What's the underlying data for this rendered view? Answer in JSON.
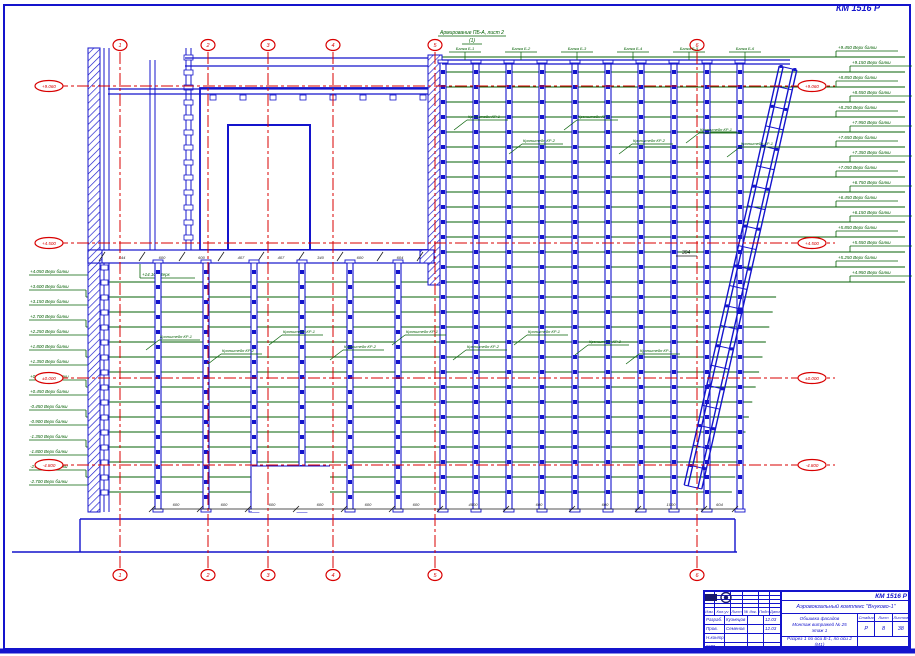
{
  "colors": {
    "blue": "#1414cc",
    "red": "#d80000",
    "green": "#046004",
    "dark": "#1a1a1a"
  },
  "doc_code_top": "КМ 1516 Р",
  "top_note": {
    "line1": "Армирование ПБ-А, лист 2",
    "line2": "(1)"
  },
  "axes": {
    "vertical": [
      {
        "x": 120,
        "label": "1"
      },
      {
        "x": 208,
        "label": "2"
      },
      {
        "x": 268,
        "label": "3"
      },
      {
        "x": 333,
        "label": "4"
      },
      {
        "x": 435,
        "label": "5"
      },
      {
        "x": 697,
        "label": "6"
      }
    ],
    "horizontal": [
      {
        "y": 86,
        "label": "+9.060"
      },
      {
        "y": 243,
        "label": "+4.500"
      },
      {
        "y": 378,
        "label": "±0.000"
      },
      {
        "y": 465,
        "label": "-4.800"
      }
    ]
  },
  "right_labels": [
    "+9.450 Верх балки",
    "+9.150 Верх балки",
    "+8.850 Верх балки",
    "+8.550 Верх балки",
    "+8.250 Верх балки",
    "+7.950 Верх балки",
    "+7.650 Верх балки",
    "+7.350 Верх балки",
    "+7.050 Верх балки",
    "+6.750 Верх балки",
    "+6.450 Верх балки",
    "+6.150 Верх балки",
    "+5.850 Верх балки",
    "+5.550 Верх балки",
    "+5.250 Верх балки",
    "+4.950 Верх балки"
  ],
  "left_labels": [
    "+4.050 Верх балки",
    "+3.600 Верх балки",
    "+3.150 Верх балки",
    "+2.700 Верх балки",
    "+2.250 Верх балки",
    "+1.800 Верх балки",
    "+1.350 Верх балки",
    "+0.900 Верх балки",
    "+0.450 Верх балки",
    "-0.450 Верх балки",
    "-0.900 Верх балки",
    "-1.350 Верх балки",
    "-1.800 Верх балки",
    "-2.250 Верх балки",
    "-2.700 Верх балки"
  ],
  "top_labels": [
    "Балка Б-1",
    "Балка Б-2",
    "Балка Б-3",
    "Балка Б-4",
    "Балка Б-5",
    "Балка Б-6"
  ],
  "bracket_labels": [
    {
      "x": 468,
      "y": 118,
      "t": "Кронштейн КР-1"
    },
    {
      "x": 523,
      "y": 142,
      "t": "Кронштейн КР-2"
    },
    {
      "x": 578,
      "y": 118,
      "t": "Кронштейн КР-1"
    },
    {
      "x": 633,
      "y": 142,
      "t": "Кронштейн КР-2"
    },
    {
      "x": 700,
      "y": 131,
      "t": "Кронштейн КР-1"
    },
    {
      "x": 741,
      "y": 145,
      "t": "Кронштейн КР-1"
    },
    {
      "x": 160,
      "y": 338,
      "t": "Кронштейн КР-1"
    },
    {
      "x": 222,
      "y": 352,
      "t": "Кронштейн КР-2"
    },
    {
      "x": 283,
      "y": 333,
      "t": "Кронштейн КР-1"
    },
    {
      "x": 344,
      "y": 348,
      "t": "Кронштейн КР-2"
    },
    {
      "x": 406,
      "y": 333,
      "t": "Кронштейн КР-1"
    },
    {
      "x": 467,
      "y": 348,
      "t": "Кронштейн КР-2"
    },
    {
      "x": 528,
      "y": 333,
      "t": "Кронштейн КР-1"
    },
    {
      "x": 589,
      "y": 343,
      "t": "Кронштейн КР-2"
    },
    {
      "x": 640,
      "y": 352,
      "t": "Кронштейн КР-1"
    }
  ],
  "dim_304": "304",
  "beam_note": "+14.100 Верх",
  "dims_upper": [
    "444",
    "600",
    "600",
    "407",
    "407",
    "340",
    "600",
    "604"
  ],
  "dims_lower": [
    "600",
    "600",
    "600",
    "600",
    "600",
    "600",
    "4500",
    "600",
    "600",
    "1000",
    "604"
  ],
  "titleblock": {
    "code": "КМ 1516 Р",
    "project": "Аэровокзальный комплекс \"Внуково-1\"",
    "object_lines": [
      "Обшивка фасадов",
      "Монтаж витражей № 25",
      "этаж 1"
    ],
    "title_lines": [
      "Разрез 1 по оси Б-1, по оси 2",
      "(М1)"
    ],
    "stage_headers": [
      "Стадия",
      "Лист",
      "Листов"
    ],
    "stage_values": [
      "Р",
      "8",
      "38"
    ],
    "header_cols": [
      "Изм.",
      "Кол.уч",
      "Лист",
      "№ док.",
      "Подп.",
      "Дата"
    ],
    "sign_rows": [
      [
        "Разраб.",
        "Кузнецов",
        "",
        "12.03"
      ],
      [
        "Пров.",
        "Семенов",
        "",
        "12.03"
      ],
      [
        "Н.контр.",
        "",
        "",
        ""
      ],
      [
        "ГИП",
        "",
        "",
        ""
      ]
    ]
  }
}
